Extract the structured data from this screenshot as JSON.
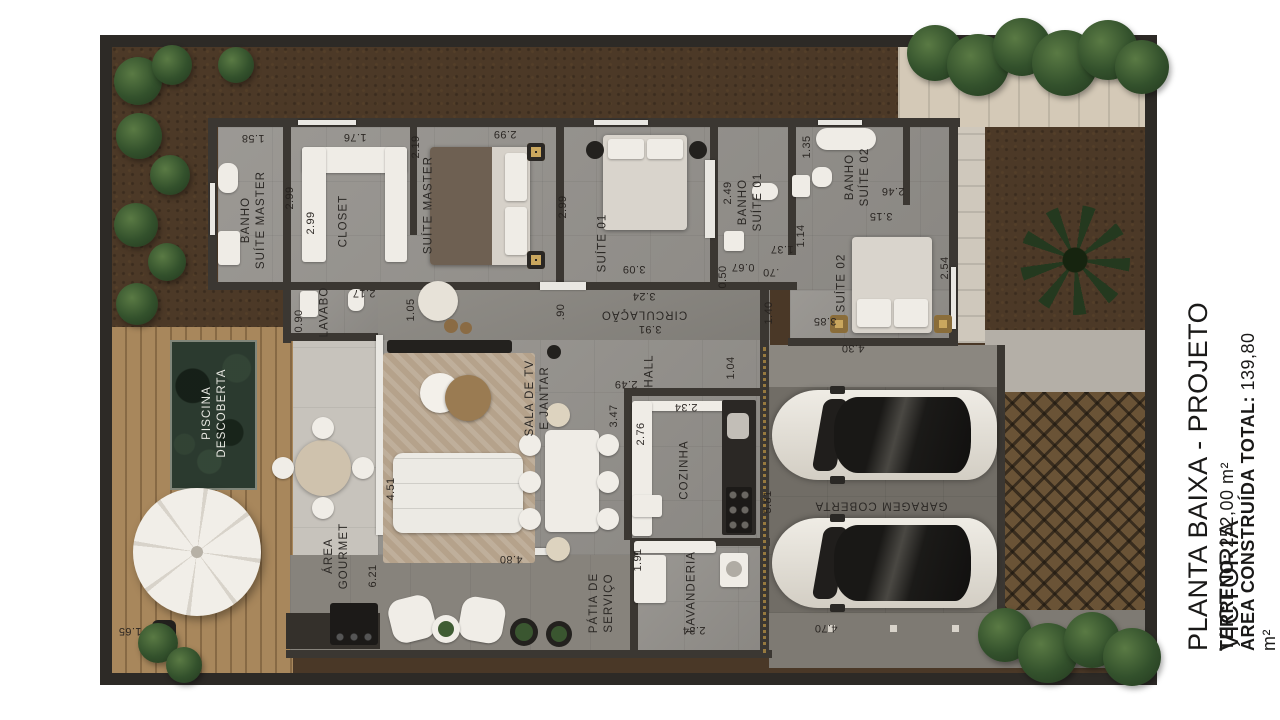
{
  "title_block": {
    "title": "PLANTA BAIXA - PROJETO VICTORIA",
    "terreno_label": "TERRENO:",
    "terreno_value": " 252,00 m²",
    "area_label": "ÁREA CONSTRUÍDA TOTAL:",
    "area_value": " 139,80 m²"
  },
  "plan": {
    "rooms": {
      "banho_master": "BANHO\nSUÍTE MASTER",
      "closet": "CLOSET",
      "suite_master": "SUÍTE MASTER",
      "suite01": "SUÍTE 01",
      "banho01": "BANHO\nSUÍTE 01",
      "banho02": "BANHO\nSUÍTE 02",
      "suite02": "SUÍTE 02",
      "lavabo": "LAVABO",
      "circulacao": "CIRCULAÇÃO",
      "hall": "HALL",
      "sala": "SALA DE TV\nE JANTAR",
      "cozinha": "COZINHA",
      "lavanderia": "LAVANDERIA",
      "patia": "PÁTIA DE\nSERVIÇO",
      "area_gourmet": "ÁREA\nGOURMET",
      "piscina": "PISCINA\nDESCOBERTA",
      "garagem": "GARAGEM COBERTA"
    },
    "dims": {
      "banho_master_w": "1.58",
      "closet_w": "1.76",
      "suite_master_w": "2.99",
      "suite_master_l": "2.19",
      "banho_master_h": "2.99",
      "closet_h": "2.99",
      "suite01_l": "2.99",
      "suite01_w": "3.09",
      "circ_w": "3.24",
      "circ_l": "3.91",
      "lavabo_w": "2.17",
      "lavabo_h": "0.90",
      "closet_door": "1.05",
      "sala_door": ".90",
      "banho01_h": "2.49",
      "banho01_w": "1.37",
      "banho01_a": "0.67",
      "banho01_b": ".70",
      "banho01_c": "1.14",
      "banho01_d": "0.50",
      "banho02_w": "1.35",
      "banho02_l": "2.46",
      "suite02_w": "3.15",
      "suite02_h": "2.54",
      "suite02_a": "3.85",
      "suite02_b": "4.30",
      "hall_w": "2.49",
      "hall_d": "1.40",
      "hall_r": "1.04",
      "cozinha_w": "2.34",
      "cozinha_h": "2.76",
      "sala_w": "4.80",
      "sala_h": "3.47",
      "sala_l": "4.51",
      "lavanderia_h": "1.91",
      "lavanderia_w": "2.34",
      "gourmet_h": "6.21",
      "gourmet_w": "1.65",
      "garage_h": "5.81",
      "garage_w": "4.70"
    }
  }
}
